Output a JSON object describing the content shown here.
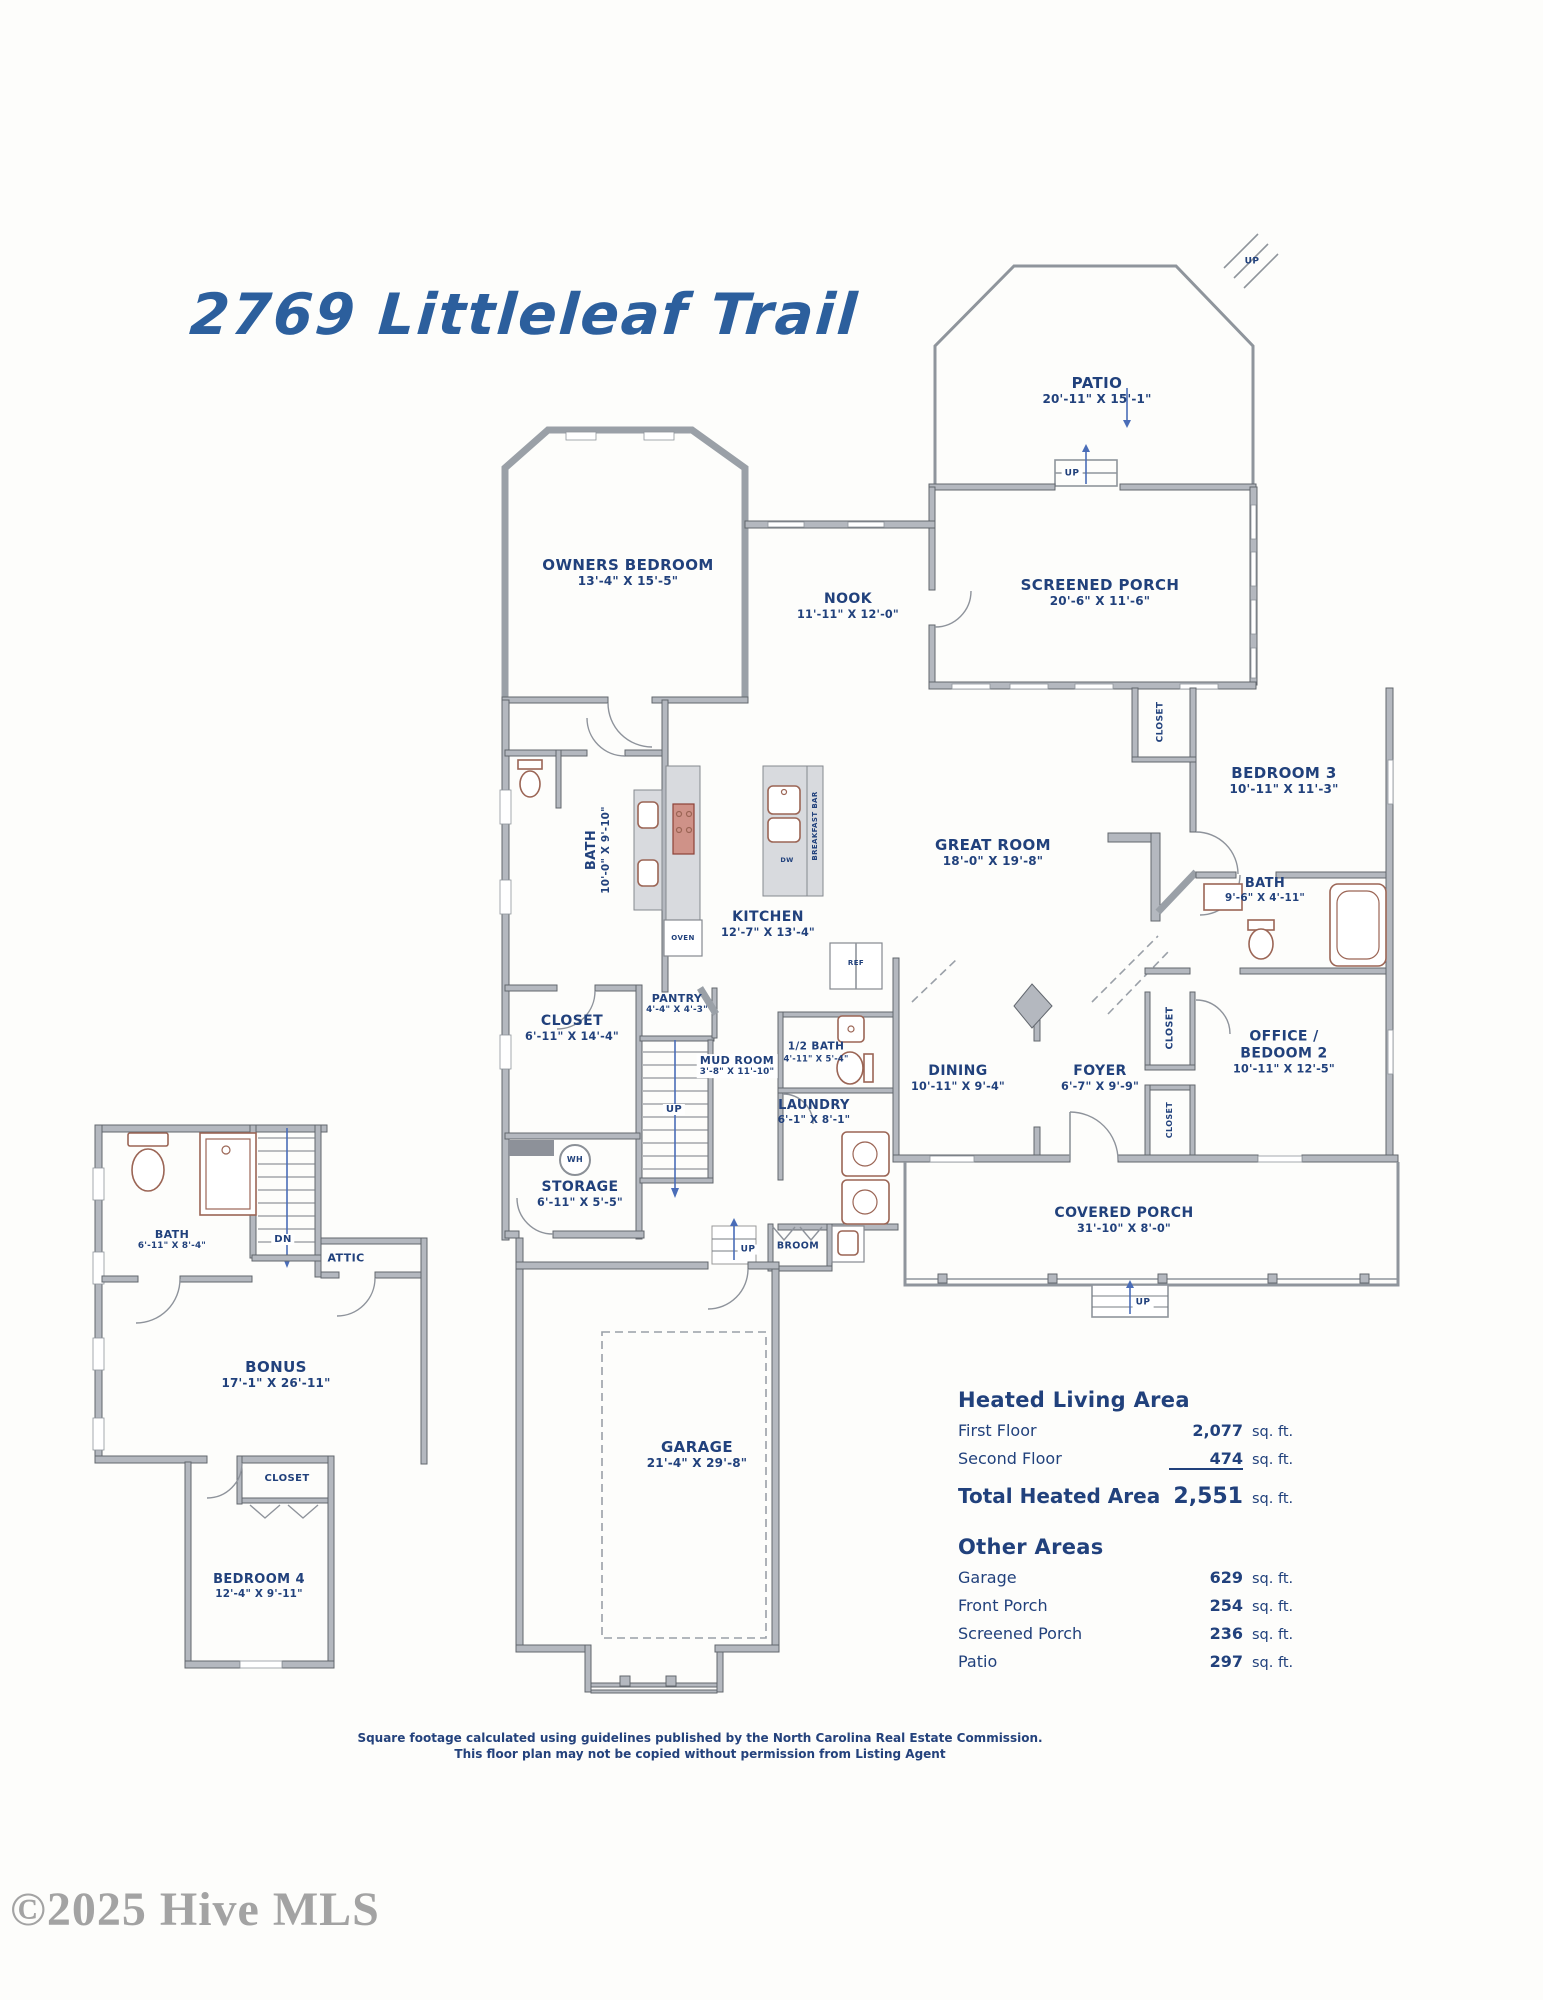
{
  "page": {
    "title": "2769 Littleleaf Trail"
  },
  "rooms": {
    "patio": {
      "name": "PATIO",
      "dims": "20'-11\" X 15'-1\""
    },
    "screened_porch": {
      "name": "SCREENED PORCH",
      "dims": "20'-6\" X 11'-6\""
    },
    "owners_bedroom": {
      "name": "OWNERS BEDROOM",
      "dims": "13'-4\" X 15'-5\""
    },
    "nook": {
      "name": "NOOK",
      "dims": "11'-11\" X 12'-0\""
    },
    "great_room": {
      "name": "GREAT ROOM",
      "dims": "18'-0\" X 19'-8\""
    },
    "bedroom3": {
      "name": "BEDROOM 3",
      "dims": "10'-11\" X 11'-3\""
    },
    "bath_hall": {
      "name": "BATH",
      "dims": "9'-6\" X 4'-11\""
    },
    "owners_bath": {
      "name": "BATH",
      "dims": "10'-0\" X 9'-10\""
    },
    "kitchen": {
      "name": "KITCHEN",
      "dims": "12'-7\" X 13'-4\""
    },
    "closet_owners": {
      "name": "CLOSET",
      "dims": "6'-11\" X 14'-4\""
    },
    "pantry": {
      "name": "PANTRY",
      "dims": "4'-4\" X 4'-3\""
    },
    "mud_room": {
      "name": "MUD ROOM",
      "dims": "3'-8\" X 11'-10\""
    },
    "half_bath": {
      "name": "1/2 BATH",
      "dims": "4'-11\" X 5'-4\""
    },
    "laundry": {
      "name": "LAUNDRY",
      "dims": "6'-1\" X 8'-1\""
    },
    "storage": {
      "name": "STORAGE",
      "dims": "6'-11\" X 5'-5\""
    },
    "dining": {
      "name": "DINING",
      "dims": "10'-11\" X 9'-4\""
    },
    "foyer": {
      "name": "FOYER",
      "dims": "6'-7\" X 9'-9\""
    },
    "office_bedroom2": {
      "name": "OFFICE /",
      "name2": "BEDOOM 2",
      "dims": "10'-11\" X 12'-5\""
    },
    "covered_porch": {
      "name": "COVERED PORCH",
      "dims": "31'-10\" X 8'-0\""
    },
    "garage": {
      "name": "GARAGE",
      "dims": "21'-4\" X 29'-8\""
    },
    "bath_upstairs": {
      "name": "BATH",
      "dims": "6'-11\" X 8'-4\""
    },
    "bonus": {
      "name": "BONUS",
      "dims": "17'-1\" X 26'-11\""
    },
    "bedroom4": {
      "name": "BEDROOM 4",
      "dims": "12'-4\" X 9'-11\""
    }
  },
  "tags": {
    "up": "UP",
    "dn": "DN",
    "attic": "ATTIC",
    "closet": "CLOSET",
    "broom": "BROOM",
    "wh": "WH",
    "dw": "DW",
    "oven": "OVEN",
    "ref": "REF",
    "breakfast_bar": "BREAKFAST BAR"
  },
  "area_summary": {
    "heated_title": "Heated Living Area",
    "rows": [
      {
        "label": "First Floor",
        "value": "2,077",
        "unit": "sq. ft."
      },
      {
        "label": "Second Floor",
        "value": "474",
        "unit": "sq. ft."
      }
    ],
    "total_label": "Total Heated Area",
    "total_value": "2,551",
    "total_unit": "sq. ft.",
    "other_title": "Other Areas",
    "other_rows": [
      {
        "label": "Garage",
        "value": "629",
        "unit": "sq. ft."
      },
      {
        "label": "Front Porch",
        "value": "254",
        "unit": "sq. ft."
      },
      {
        "label": "Screened Porch",
        "value": "236",
        "unit": "sq. ft."
      },
      {
        "label": "Patio",
        "value": "297",
        "unit": "sq. ft."
      }
    ]
  },
  "disclaimer": {
    "line1": "Square footage calculated using guidelines published by the North Carolina Real Estate Commission.",
    "line2": "This floor plan may not be copied without permission from Listing Agent"
  },
  "watermark": "©2025 Hive MLS",
  "colors": {
    "label_blue": "#21417c",
    "title_blue": "#2c5f9d",
    "wall_gray": "#b4b8bf",
    "fixture_brown": "#9b6555",
    "stair_blue": "#4a6db8",
    "watermark_gray": "#a3a3a3"
  }
}
